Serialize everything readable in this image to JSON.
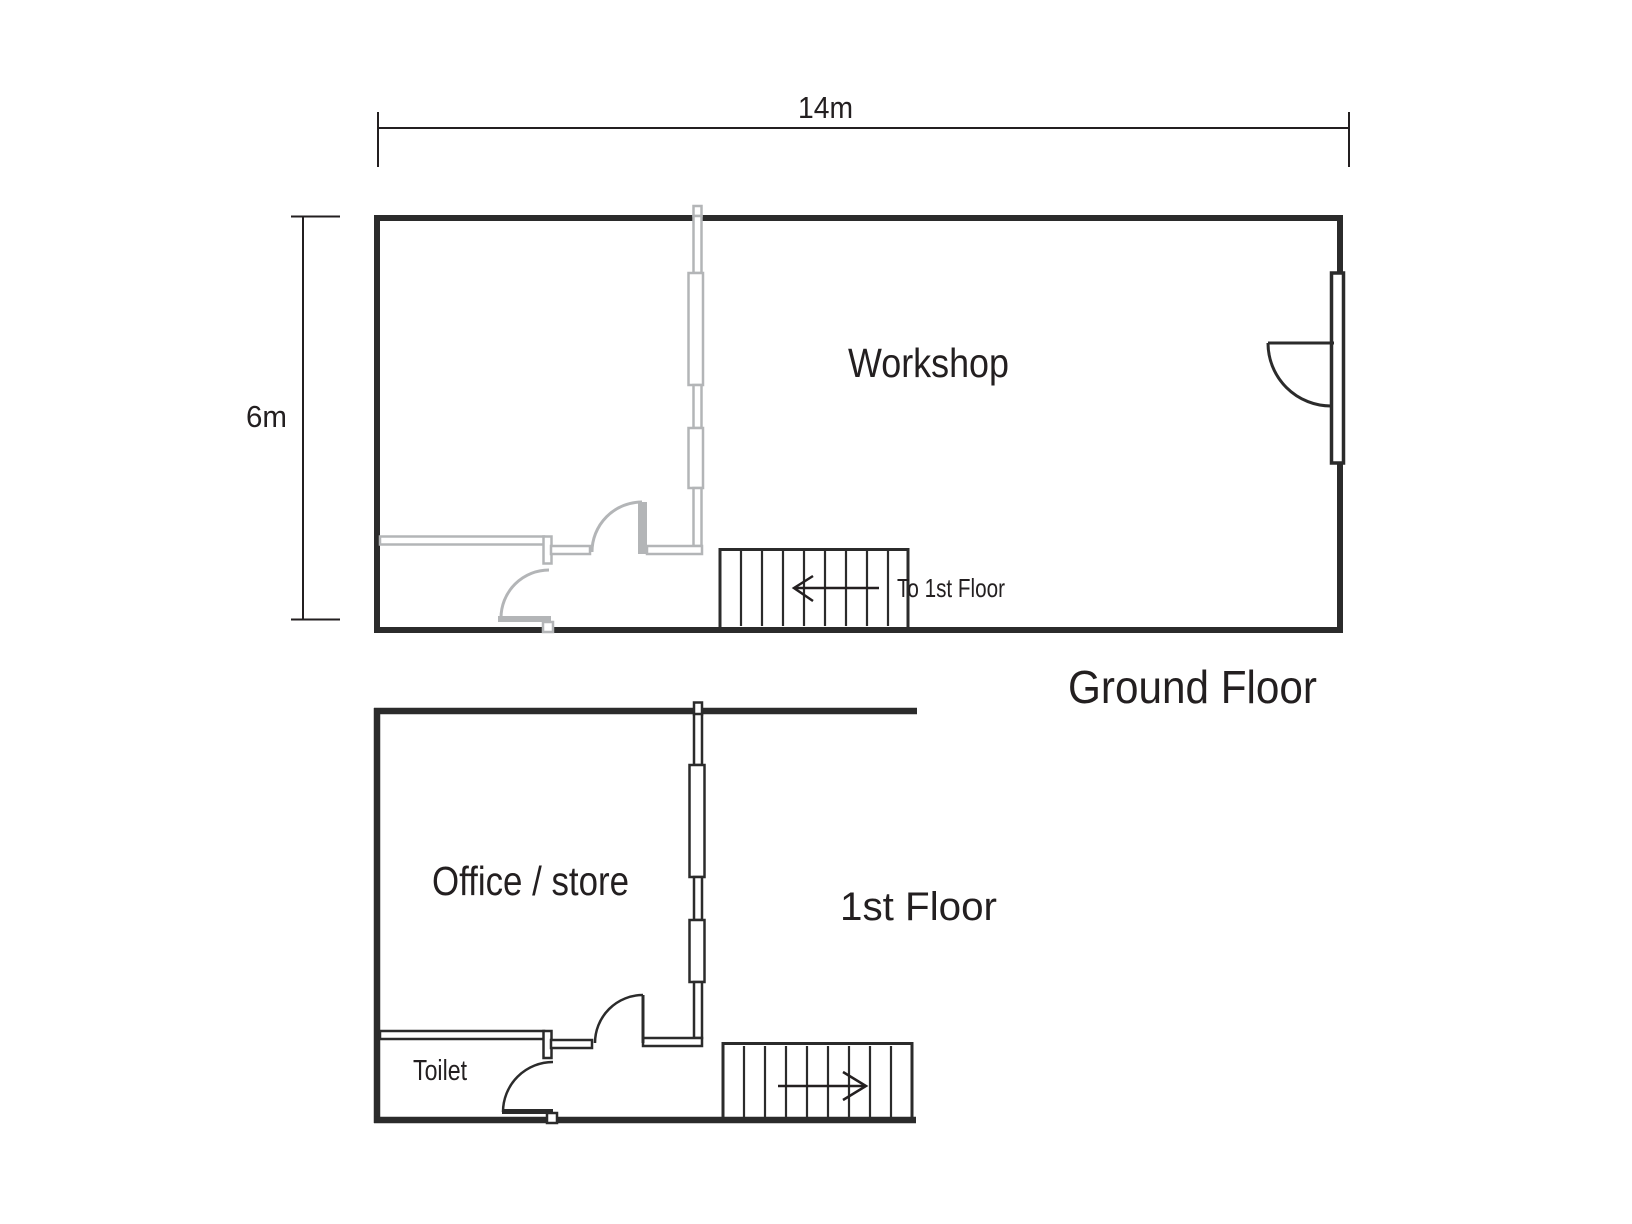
{
  "page": {
    "background": "#ffffff"
  },
  "colors": {
    "wall_black": "#2b2b2b",
    "interior_gray": "#b3b5b7",
    "text": "#231f20"
  },
  "ground_floor": {
    "title": "Ground Floor",
    "room_label": "Workshop",
    "stairs_label": "To 1st Floor",
    "stairs_direction": "left",
    "dimensions": {
      "width_label": "14m",
      "height_label": "6m"
    }
  },
  "first_floor": {
    "title": "1st Floor",
    "room_label": "Office / store",
    "toilet_label": "Toilet",
    "stairs_direction": "right"
  }
}
